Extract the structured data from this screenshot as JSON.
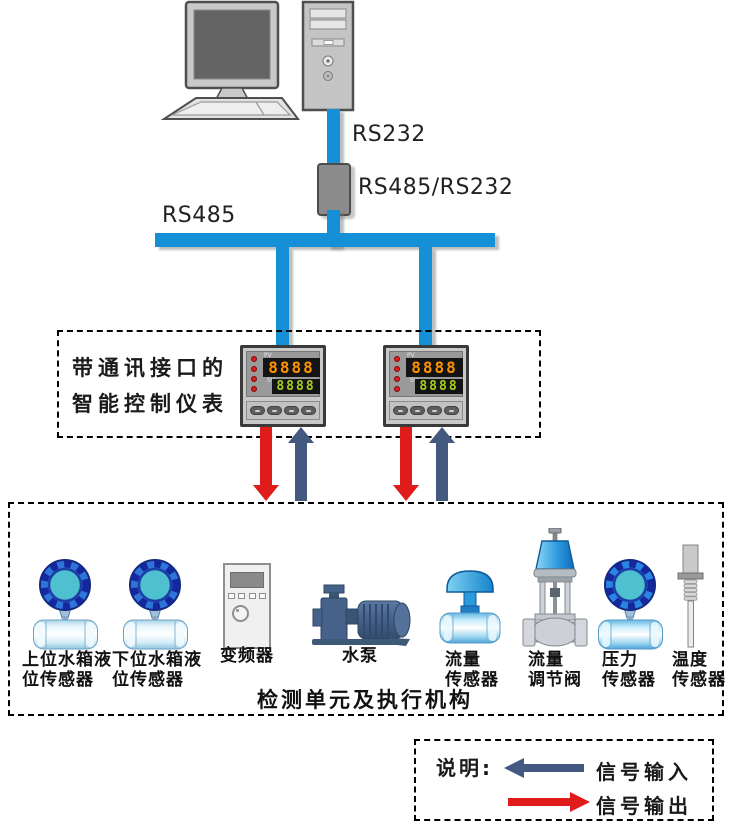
{
  "network": {
    "rs232_label": "RS232",
    "converter_label": "RS485/RS232",
    "rs485_label": "RS485"
  },
  "controller_box": {
    "title_line1": "带通讯接口的",
    "title_line2": "智能控制仪表",
    "instruments": [
      {
        "pv_label": "PV",
        "pv_value": "8888",
        "sv_label": "SV",
        "sv_value": "8888"
      },
      {
        "pv_label": "PV",
        "pv_value": "8888",
        "sv_label": "SV",
        "sv_value": "8888"
      }
    ]
  },
  "device_box": {
    "title": "检测单元及执行机构",
    "devices": [
      {
        "label": "上位水箱液\n位传感器"
      },
      {
        "label": "下位水箱液\n位传感器"
      },
      {
        "label": "变频器"
      },
      {
        "label": "水泵"
      },
      {
        "label": "流量\n传感器"
      },
      {
        "label": "流量\n调节阀"
      },
      {
        "label": "压力\n传感器"
      },
      {
        "label": "温度\n传感器"
      }
    ]
  },
  "legend": {
    "title": "说明:",
    "input_label": "信号输入",
    "output_label": "信号输出"
  },
  "colors": {
    "bus_blue": "#1590d7",
    "signal_input_navy": "#44597f",
    "signal_output_red": "#e01b1b",
    "sensor_teal": "#4fc0cf",
    "sensor_navy_ring": "#14279c"
  }
}
